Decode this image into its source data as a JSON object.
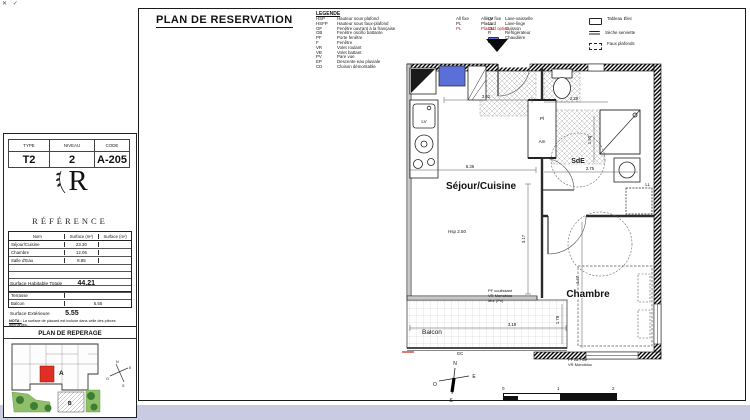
{
  "corner_marks": "✕ ✓",
  "title": "PLAN DE RESERVATION",
  "colors": {
    "accent_red": "#cc2222",
    "chaudiere_blue": "#5b6fd8",
    "site_green": "#8fbf6a",
    "bottom_strip": "#c9cbe2"
  },
  "legend": {
    "heading": "LEGENDE",
    "col1": [
      {
        "abbr": "HSP",
        "label": "Hauteur sous plafond"
      },
      {
        "abbr": "HSFP",
        "label": "Hauteur sous faux-plafond"
      },
      {
        "abbr": "OF",
        "label": "Fenêtre ouvrant à la française"
      },
      {
        "abbr": "OB",
        "label": "Fenêtre oscillo battante"
      },
      {
        "abbr": "PF",
        "label": "Porte fenêtre"
      },
      {
        "abbr": "F",
        "label": "Fenêtre"
      },
      {
        "abbr": "VR",
        "label": "Volet roulant"
      },
      {
        "abbr": "VB",
        "label": "Volet battant"
      },
      {
        "abbr": "PV",
        "label": "Pare vue"
      },
      {
        "abbr": "EP",
        "label": "Descente eau pluviale"
      },
      {
        "abbr": "CD",
        "label": "Cloison démontable"
      }
    ],
    "col2": [
      {
        "abbr": "All fixe",
        "label": "Allège fixe"
      },
      {
        "abbr": "PL",
        "label": "Placard"
      },
      {
        "abbr": "PL",
        "label": "Placard option"
      }
    ],
    "col3": [
      {
        "abbr": "LV",
        "label": "Lave-vaisselle"
      },
      {
        "abbr": "LL",
        "label": "Lave-linge"
      },
      {
        "abbr": "CU",
        "label": "Cuisson"
      },
      {
        "abbr": "R",
        "label": "Réfrigérateur"
      },
      {
        "abbr": "",
        "label": "Chaudière"
      }
    ],
    "col4": [
      {
        "label": "Tableau Élec"
      },
      {
        "label": "Sèche serviette"
      },
      {
        "label": "Faux plafonds"
      }
    ]
  },
  "info": {
    "headers": [
      "TYPE",
      "NIVEAU",
      "CODE"
    ],
    "values": [
      "T2",
      "2",
      "A-205"
    ]
  },
  "brand": {
    "initial": "R",
    "name": "RÉFÉRENCE"
  },
  "surfaces": {
    "col_nom": "Nom",
    "col_s1": "Surface (m²)",
    "col_s2": "Surface (m²)",
    "rows": [
      {
        "nom": "Séjour/Cuisine",
        "s": "23.30"
      },
      {
        "nom": "Chambre",
        "s": "12.06"
      },
      {
        "nom": "Salle d'Eau",
        "s": "8.85"
      }
    ],
    "total_label": "Surface Habitable Totale",
    "total": "44.21",
    "ext": [
      {
        "nom": "Terrasse",
        "s": ""
      },
      {
        "nom": "Balcon",
        "s": "5.55"
      }
    ],
    "ext_label": "Surface Extérieure",
    "ext_total": "5.55",
    "nota_label": "NOTA :",
    "nota_text": "La surface de placard est incluse dans celle des pièces attenantes."
  },
  "reperage": {
    "heading": "PLAN DE REPERAGE",
    "unit_a": "A",
    "unit_b": "B"
  },
  "plan": {
    "sejour": "Séjour/Cuisine",
    "chambre": "Chambre",
    "sde": "SdE",
    "balcon": "Balcon",
    "hsp": "Hsp 2.50",
    "lv": "LV",
    "ll": "LL",
    "pl": "Pl",
    "am": "Am",
    "gc": "GC",
    "win_balcon_1": "PF coulissant",
    "win_balcon_2": "VR Monobloc",
    "win_balcon_3": "Mur (Pv)",
    "win_chambre_1": "PF All Fixe",
    "win_chambre_2": "VR Monobloc",
    "dims": {
      "entree": "3.62",
      "sejour_l": "5.36",
      "sejour_h": "3.17",
      "sde_l": "2.29",
      "sde_h": "1.90",
      "sde_l2": "2.75",
      "chambre_h": "4.47",
      "balcon_l": "3.19",
      "balcon_h": "1.78"
    }
  },
  "compass": {
    "n": "N",
    "e": "E",
    "s": "S",
    "o": "O"
  },
  "scalebar": {
    "t0": "0",
    "t1": "1",
    "t2": "2"
  }
}
